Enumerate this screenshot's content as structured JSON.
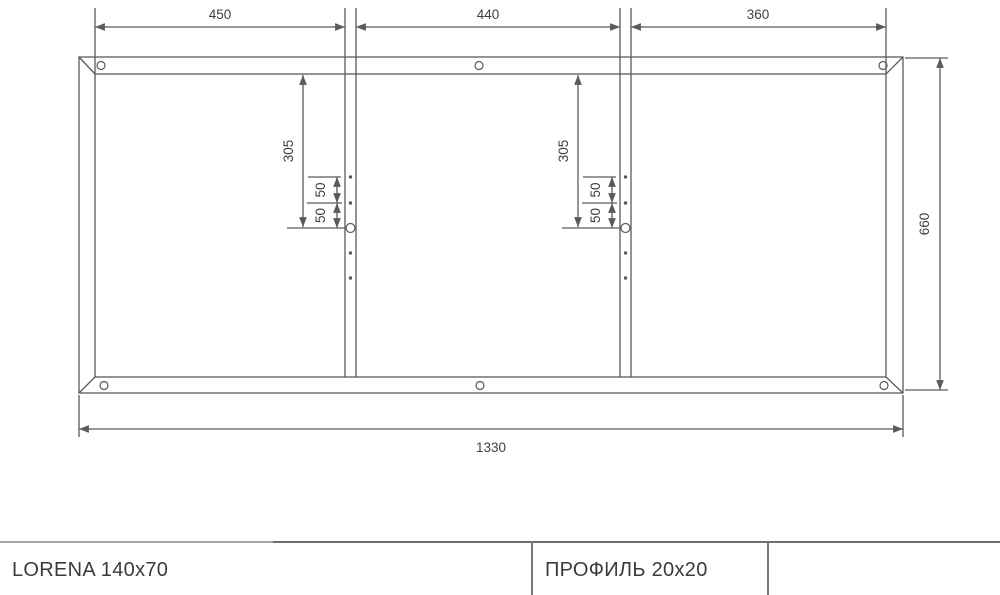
{
  "title_block": {
    "left_cell": "LORENA 140x70",
    "middle_cell": "ПРОФИЛЬ 20x20"
  },
  "dims": {
    "sections_top": [
      "450",
      "440",
      "360"
    ],
    "frame_height": "660",
    "frame_width": "1330",
    "crossbar_hole_offset": "305",
    "hole_spacing_upper": "50",
    "hole_spacing_lower": "50"
  },
  "drawing": {
    "description": "welded rectangular frame, 3 sections, 2 crossbars with holes",
    "frame_hole_count": 6,
    "crossbar_hole_rows": 5
  },
  "colors": {
    "line_color": "#5a5a5a",
    "text_color": "#3f3f3f",
    "rule_light": "#a5a5a5",
    "rule_dark": "#6e6e6e",
    "title_text": "#3b3b3b"
  }
}
